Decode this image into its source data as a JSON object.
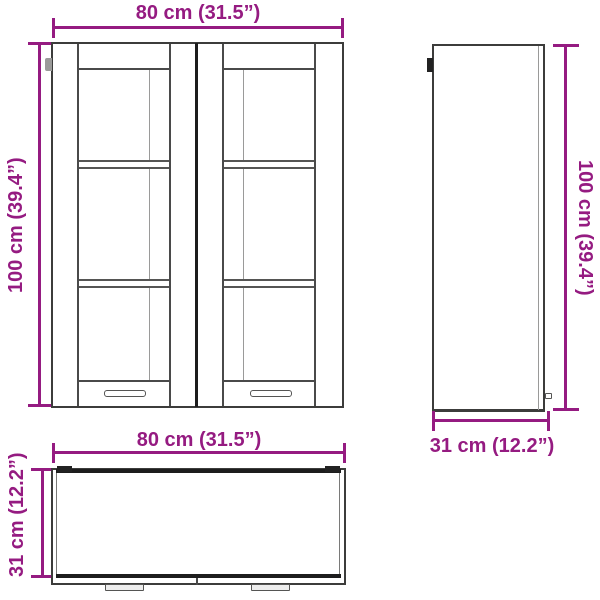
{
  "diagram": {
    "type": "furniture-dimension-drawing",
    "subject": "wall cabinet with two glass doors",
    "accent_color": "#951b81",
    "outline_color": "#3c3c3b",
    "views": {
      "front": {
        "width_label": "80 cm (31.5”)",
        "height_label": "100 cm (39.4”)"
      },
      "side": {
        "height_label": "100 cm (39.4”)",
        "depth_label": "31 cm (12.2”)"
      },
      "top": {
        "width_label": "80 cm (31.5”)",
        "depth_label": "31 cm (12.2”)"
      }
    }
  }
}
